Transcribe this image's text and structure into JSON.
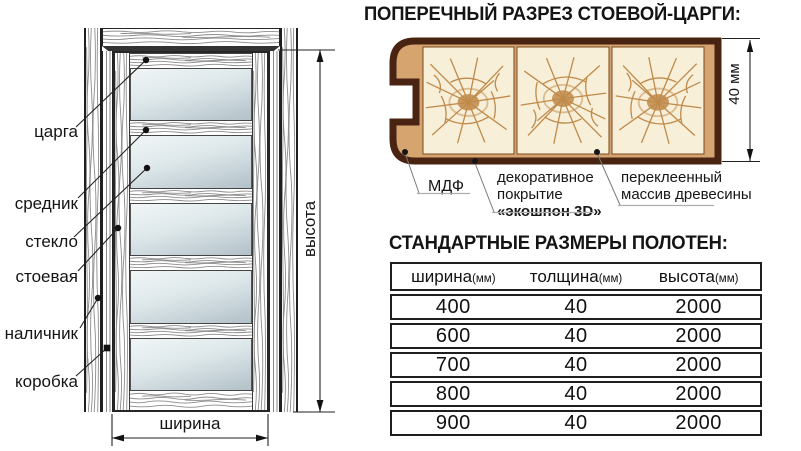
{
  "door_diagram": {
    "part_labels": {
      "tsarga": "царга",
      "srednik": "средник",
      "steklo": "стекло",
      "stoevaya": "стоевая",
      "nalichnik": "наличник",
      "korobka": "коробка"
    },
    "dim_height": "высота",
    "dim_width": "ширина"
  },
  "cross_section": {
    "title": "ПОПЕРЕЧНЫЙ РАЗРЕЗ СТОЕВОЙ-ЦАРГИ:",
    "dim_thickness": "40 мм",
    "labels": {
      "mdf": "МДФ",
      "coating_l1": "декоративное",
      "coating_l2": "покрытие",
      "coating_l3": "«экошпон 3D»",
      "wood_l1": "переклеенный",
      "wood_l2": "массив древесины"
    },
    "colors": {
      "outline": "#4a2412",
      "fill": "#d6a46e",
      "panel": "#f7efd8",
      "grain": "#c08a4a"
    }
  },
  "sizes_table": {
    "title": "СТАНДАРТНЫЕ РАЗМЕРЫ ПОЛОТЕН:",
    "headers": [
      {
        "name": "ширина",
        "unit": "(мм)"
      },
      {
        "name": "толщина",
        "unit": "(мм)"
      },
      {
        "name": "высота",
        "unit": "(мм)"
      }
    ],
    "rows": [
      [
        "400",
        "40",
        "2000"
      ],
      [
        "600",
        "40",
        "2000"
      ],
      [
        "700",
        "40",
        "2000"
      ],
      [
        "800",
        "40",
        "2000"
      ],
      [
        "900",
        "40",
        "2000"
      ]
    ]
  }
}
